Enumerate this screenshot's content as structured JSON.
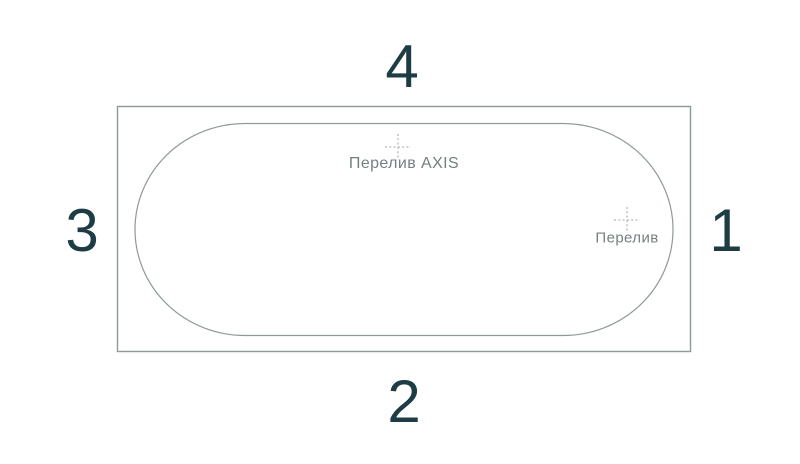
{
  "drawing": {
    "side_labels": {
      "top": "4",
      "bottom": "2",
      "left": "3",
      "right": "1"
    },
    "markers": [
      {
        "label": "Перелив AXIS"
      },
      {
        "label": "Перелив"
      }
    ],
    "colors": {
      "background": "#ffffff",
      "outline": "#8e9a98",
      "number": "#1e3c44",
      "marker_label": "#74807f",
      "center_mark": "#9aa5a3"
    }
  }
}
